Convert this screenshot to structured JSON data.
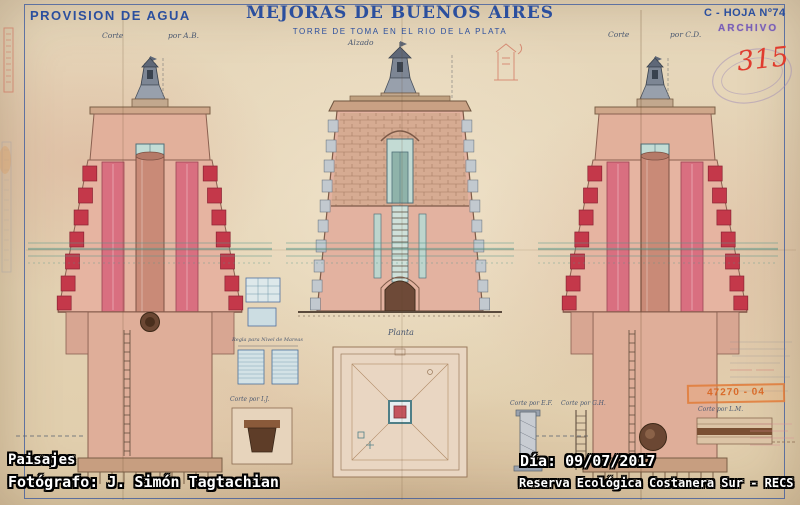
{
  "header": {
    "left_title": "PROVISION DE AGUA",
    "title": "MEJORAS DE BUENOS AIRES",
    "subtitle": "TORRE DE TOMA EN EL RIO DE LA PLATA",
    "sheet_number": "C - HOJA Nº74",
    "archive_stamp": "ARCHIVO",
    "handwritten_number": "315"
  },
  "drawing": {
    "labels": {
      "left_section": [
        "Corte",
        "por A.B."
      ],
      "center_elevation": "Alzado",
      "right_section": [
        "Corte",
        "por C.D."
      ],
      "plan": "Planta",
      "detail_ef": "Corte por E.F.",
      "detail_gh": "Corte por G.H.",
      "detail_ij": "Corte por I.J.",
      "detail_lm": "Corte por L.M.",
      "tide_gauge": "Regla para Nivel de Mareas",
      "stamp_number": "47270 - 04"
    }
  },
  "overlay": {
    "album": "Paisajes",
    "photographer": "Fotógrafo: J. Simón Tagtachian",
    "date": "Día: 09/07/2017",
    "location": "Reserva Ecológica Costanera Sur - RECS"
  },
  "colors": {
    "ink_blue": "#2b4f9e",
    "handwriting_red": "#e03c2e",
    "stamp_violet": "#7a5fb5",
    "stamp_orange": "#e07b3a",
    "paper_tan": "#e4d3b6",
    "wash_pink": "#e3b2a0",
    "brick_red": "#c4384a",
    "water_teal": "#55968a"
  }
}
